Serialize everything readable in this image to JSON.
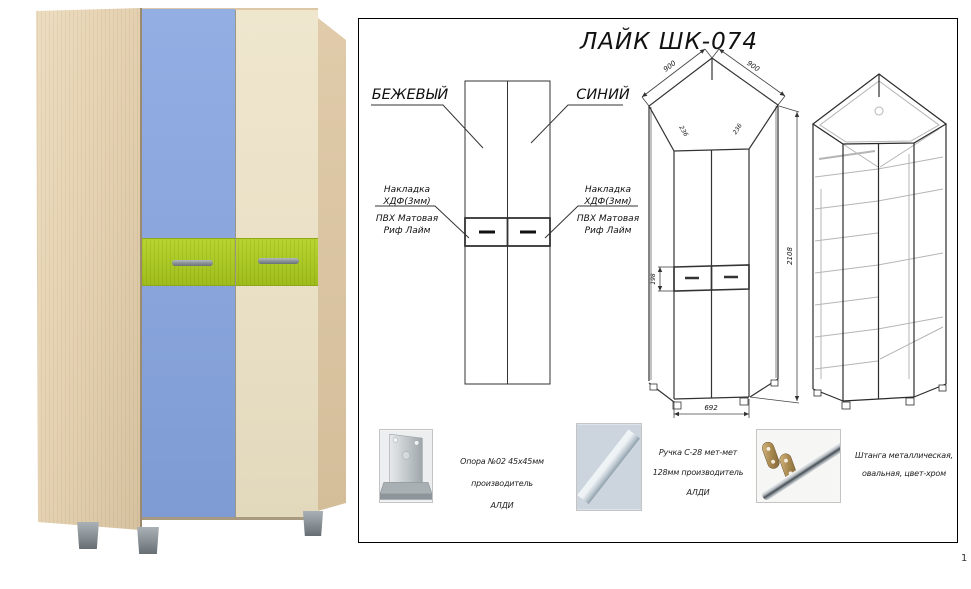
{
  "page": {
    "number": "1"
  },
  "photo": {
    "subject": "corner wardrobe render",
    "colors": {
      "wood": "#e3d0af",
      "blue_door": "#87a3da",
      "beige_door": "#e9dfc5",
      "lime_drawer": "#a9c724",
      "handle": "#848c91",
      "foot": "#868e93"
    }
  },
  "sheet": {
    "title": "ЛАЙК ШК-074",
    "front_view": {
      "label_left": "БЕЖЕВЫЙ",
      "label_right": "СИНИЙ",
      "annotation_left": {
        "line1": "Накладка",
        "line2": "ХДФ(3мм)",
        "line3": "ПВХ Матовая",
        "line4": "Риф Лайм"
      },
      "annotation_right": {
        "line1": "Накладка",
        "line2": "ХДФ(3мм)",
        "line3": "ПВХ Матовая",
        "line4": "Риф Лайм"
      }
    },
    "dimensions": {
      "top_left": "900",
      "top_right": "900",
      "angle_left": "236",
      "angle_right": "236",
      "height": "2108",
      "drawer_height": "198",
      "front_width": "692"
    },
    "hardware": [
      {
        "lines": [
          "Опора №02 45х45мм производитель",
          "АЛДИ"
        ]
      },
      {
        "lines": [
          "Ручка С-28 мет-мет",
          "128мм производитель",
          "АЛДИ"
        ]
      },
      {
        "lines": [
          "Штанга металлическая,",
          "овальная, цвет-хром"
        ]
      }
    ]
  }
}
